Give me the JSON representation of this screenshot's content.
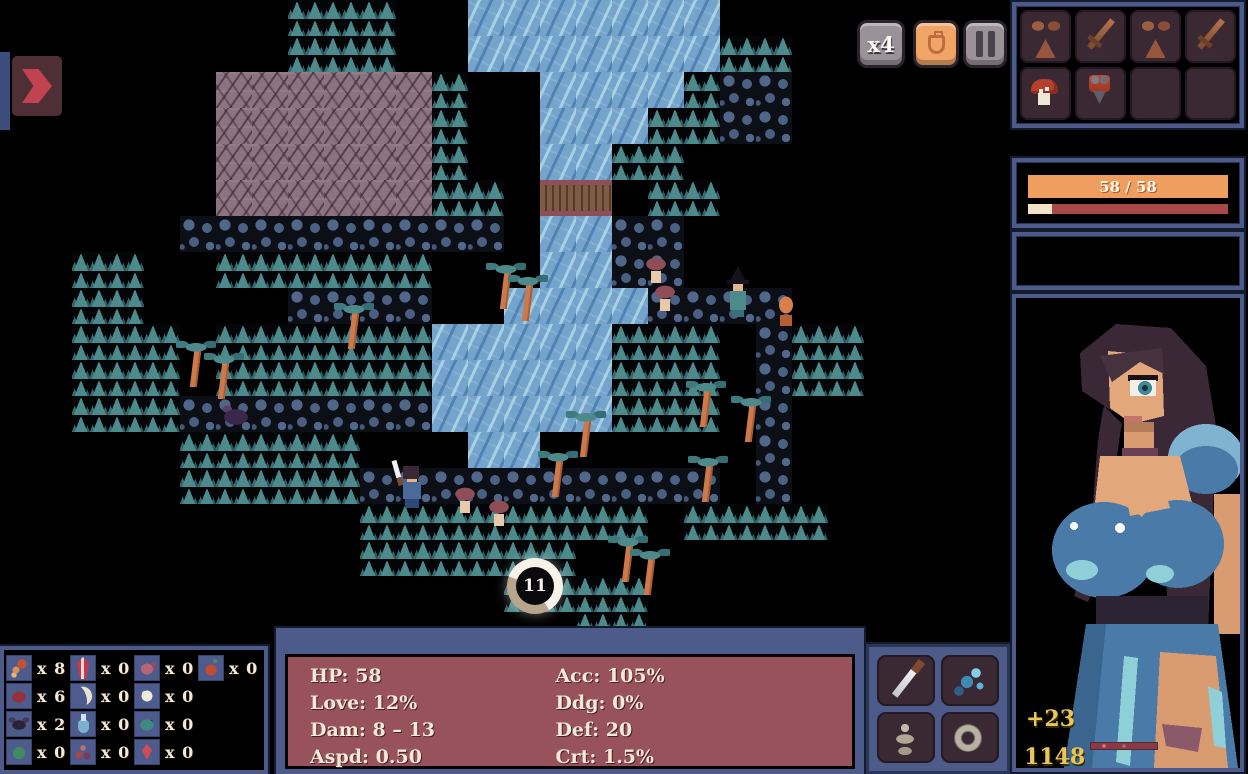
{
  "hud": {
    "speed_label": "x4",
    "bag_icon": "coin-bag",
    "pause_icon": "pause",
    "expand_icon": "arrow-right",
    "timer_value": "11"
  },
  "colors": {
    "panel_blue": "#4d5b8a",
    "stats_maroon": "#98525c",
    "hp_orange": "#f09d60",
    "xp_cream": "#f2e3c8",
    "gold_yellow": "#e9c757",
    "water_blue": "#74a3cc",
    "tree_teal": "#4d8a8c",
    "mountain_mauve": "#8b7380"
  },
  "map": {
    "tile_size": 36,
    "rows": [
      "........TTT..WWWWWWW........",
      "........TTT..WWWWWWWTT......",
      "......MMMMMMT..WWWWTPP......",
      "......MMMMMMT..WWWTTPP......",
      "......MMMMMMT..WWTT.........",
      "......MMMMMMTT.BB.TT........",
      ".....PPPPPPPPP.WWPP.........",
      "..TT..TTTTTT...WWPP.........",
      "..TT....PPPP..WWWWPPPP......",
      "..TTT.TTTTTTWWWWWTTT.PTT....",
      "..TTT.TTTTTTWWWWWTTT.PTT....",
      "..TTTPPPPPPPWWWWWTTT.P......",
      ".....TTTTT...WW......P......",
      ".....TTTTTPPPPPPPPPP.P......",
      "..........TTTTTTTT.TTTT.....",
      "..........TTTTTT............",
      "..............TTTT..........",
      "................TT..........",
      "............................",
      "............................",
      "............................",
      "............................"
    ],
    "entities": [
      {
        "type": "palm-tree",
        "x": 178,
        "y": 338,
        "interactable": false
      },
      {
        "type": "palm-tree",
        "x": 206,
        "y": 350,
        "interactable": false
      },
      {
        "type": "palm-tree",
        "x": 336,
        "y": 300,
        "interactable": false
      },
      {
        "type": "palm-tree",
        "x": 488,
        "y": 260,
        "interactable": false
      },
      {
        "type": "palm-tree",
        "x": 510,
        "y": 272,
        "interactable": false
      },
      {
        "type": "palm-tree",
        "x": 568,
        "y": 408,
        "interactable": false
      },
      {
        "type": "palm-tree",
        "x": 540,
        "y": 448,
        "interactable": false
      },
      {
        "type": "palm-tree",
        "x": 610,
        "y": 533,
        "interactable": false
      },
      {
        "type": "palm-tree",
        "x": 632,
        "y": 546,
        "interactable": false
      },
      {
        "type": "palm-tree",
        "x": 688,
        "y": 378,
        "interactable": false
      },
      {
        "type": "palm-tree",
        "x": 690,
        "y": 453,
        "interactable": false
      },
      {
        "type": "palm-tree",
        "x": 733,
        "y": 393,
        "interactable": false
      },
      {
        "type": "hero",
        "x": 394,
        "y": 464,
        "interactable": true
      },
      {
        "type": "mushroom-enemy",
        "x": 450,
        "y": 484,
        "interactable": true
      },
      {
        "type": "mushroom-enemy",
        "x": 484,
        "y": 497,
        "interactable": true
      },
      {
        "type": "mushroom-enemy",
        "x": 641,
        "y": 254,
        "interactable": true
      },
      {
        "type": "mushroom-enemy",
        "x": 650,
        "y": 282,
        "interactable": true
      },
      {
        "type": "witch-enemy",
        "x": 723,
        "y": 266,
        "interactable": true
      },
      {
        "type": "imp-enemy",
        "x": 773,
        "y": 292,
        "interactable": true
      },
      {
        "type": "shadow-enemy",
        "x": 216,
        "y": 400,
        "interactable": true
      }
    ]
  },
  "sidebar": {
    "equipment_slots": [
      "bikini-armor",
      "sword",
      "bikini-armor",
      "sword",
      "mushroom",
      "corset",
      "",
      ""
    ],
    "hp_text": "58 / 58",
    "hp_fill_pct": 100,
    "xp_fill_pct": 12,
    "gold_gain": "+23",
    "gold_total": "1148"
  },
  "stats": {
    "left": [
      {
        "label": "HP",
        "value": "58"
      },
      {
        "label": "Love",
        "value": "12%"
      },
      {
        "label": "Dam",
        "value": "8 – 13"
      },
      {
        "label": "Aspd",
        "value": "0.50"
      }
    ],
    "right": [
      {
        "label": "Acc",
        "value": "105%"
      },
      {
        "label": "Ddg",
        "value": "0%"
      },
      {
        "label": "Def",
        "value": "20"
      },
      {
        "label": "Crt",
        "value": "1.5%"
      }
    ]
  },
  "resources": {
    "rows": [
      [
        {
          "icon": "tentacle",
          "count": "x 8"
        },
        {
          "icon": "crystal",
          "count": "x 0"
        },
        {
          "icon": "shell",
          "count": "x 0"
        },
        {
          "icon": "fruit",
          "count": "x 0"
        }
      ],
      [
        {
          "icon": "meat",
          "count": "x 6"
        },
        {
          "icon": "tusk",
          "count": "x 0"
        },
        {
          "icon": "pearl",
          "count": "x 0"
        }
      ],
      [
        {
          "icon": "bat",
          "count": "x 2"
        },
        {
          "icon": "flask",
          "count": "x 0"
        },
        {
          "icon": "fish",
          "count": "x 0"
        }
      ],
      [
        {
          "icon": "sprout",
          "count": "x 0"
        },
        {
          "icon": "berries",
          "count": "x 0"
        },
        {
          "icon": "gem",
          "count": "x 0"
        }
      ]
    ]
  },
  "actions": [
    "dagger",
    "creature",
    "skeleton",
    "ring"
  ]
}
